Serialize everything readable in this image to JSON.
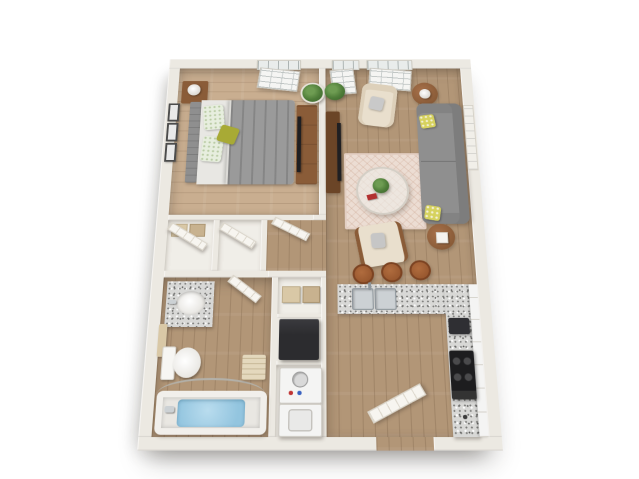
{
  "scene": {
    "kind": "3d-rendered-floor-plan",
    "description": "Top-down 3D rendering of a one-bedroom one-bathroom apartment floor plan on a white background, walls splaying slightly wider toward the bottom (perspective view)",
    "background": "#ffffff"
  },
  "palette": {
    "bg": "#ffffff",
    "wall": "#ece9e2",
    "woodLight": "#c9ae90",
    "woodMain": "#b29677",
    "closetFloor": "#f0eee8",
    "rug": "#ecddd3",
    "sofa": "#8f8f8f",
    "beige": "#e9dfcd",
    "duvet": "#9a9a9a",
    "sheet": "#e8e7e3",
    "pillowGreen": "#a8aa35",
    "headboard": "#8f8f8f",
    "wood": "#8a5c38",
    "tvBlack": "#1f1f22",
    "plant": "#4f7d39",
    "plantDark": "#38602a",
    "granite": "#d8d8d6",
    "steel": "#ccd1d4",
    "steelEdge": "#8e969c",
    "stove": "#1d1d1f",
    "fridge": "#2c2c2f",
    "appliance": "#f4f4f3",
    "dialRed": "#c03434",
    "dialBlue": "#3a62c0",
    "water": "#93c5df",
    "porcelain": "#f7f6f3",
    "towel": "#d9c8a6",
    "stool": "#99582f",
    "door": "#f7f5f0",
    "doorLine": "#ddd8cd",
    "art": "#f1efe9",
    "frameDark": "#4c4c4c"
  },
  "rooms": {
    "bedroom": {
      "name": "Bedroom",
      "position": "top-left",
      "furniture": [
        "queen bed with gray patterned duvet",
        "gray upholstered headboard",
        "two floral pillows",
        "olive green accent pillow",
        "brown nightstand with white lamp",
        "brown dresser with TV",
        "corner potted plant",
        "three wall frames",
        "open window on top wall"
      ]
    },
    "living_room": {
      "name": "Living Room",
      "position": "top-right",
      "furniture": [
        "gray sofa with two yellow floral pillows",
        "beige armchair with gray pillow",
        "beige accent chair",
        "round coffee table with plant and red book",
        "two round brown side tables with white lamp and white box",
        "dark TV stand with TV",
        "cream herringbone rug",
        "potted plant",
        "vertical wall art on right wall",
        "two open windows on top wall"
      ]
    },
    "closets": {
      "name": "Hall Closets",
      "position": "middle-left",
      "furniture": [
        "two closets with open white doors",
        "shelf baskets"
      ]
    },
    "bathroom": {
      "name": "Bathroom",
      "position": "bottom-left",
      "furniture": [
        "granite vanity with white oval sink",
        "toilet",
        "bathtub with blue water",
        "curved shower rod",
        "towel on wall bar",
        "bath mat",
        "open door"
      ]
    },
    "utility": {
      "name": "Utility / Pantry Column",
      "position": "bottom-center",
      "furniture": [
        "pantry shelf with two baskets",
        "black refrigerator unit",
        "stacked washer with round dial and red-blue knobs",
        "dryer with square door"
      ]
    },
    "kitchen": {
      "name": "Kitchen",
      "position": "bottom-right",
      "furniture": [
        "L-shaped granite counter",
        "double stainless sink",
        "three brown bar stools",
        "black range with four burners",
        "white cabinet run along right wall",
        "dark microwave"
      ]
    },
    "entry": {
      "name": "Entry",
      "position": "bottom-center-right",
      "furniture": [
        "front door shown open, lying diagonally inward"
      ]
    }
  },
  "counts": {
    "bedrooms": 1,
    "bathrooms": 1,
    "bar_stools": 3,
    "bedroom_wall_frames": 3,
    "living_room_windows": 2,
    "bedroom_windows": 1,
    "sofa_pillows": 2
  }
}
